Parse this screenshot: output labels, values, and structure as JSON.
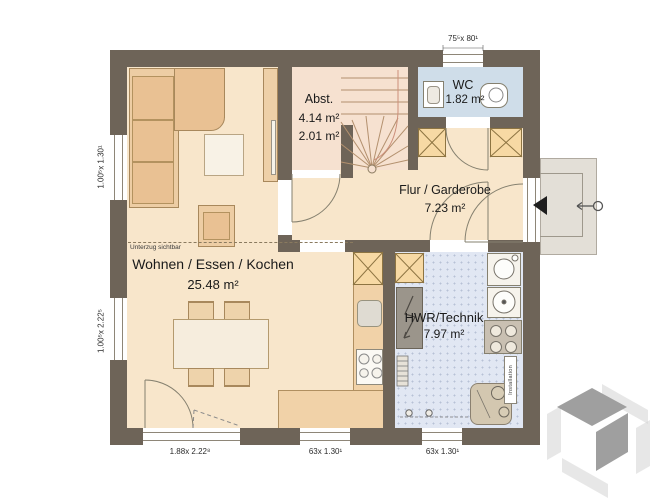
{
  "plan": {
    "rooms": {
      "wohnen": {
        "name": "Wohnen / Essen / Kochen",
        "area": "25.48 m²"
      },
      "abst": {
        "name": "Abst.",
        "area1": "4.14 m²",
        "area2": "2.01 m²"
      },
      "wc": {
        "name": "WC",
        "area": "1.82 m²"
      },
      "flur": {
        "name": "Flur / Garderobe",
        "area": "7.23 m²"
      },
      "hwr": {
        "name": "HWR/Technik",
        "area": "7.97 m²"
      }
    },
    "annotations": {
      "unterzug": "Unterzug sichtbar",
      "installation": "Installation"
    },
    "dimensions": {
      "top_window": "75⁵x 80¹",
      "left_upper_window": "1.00⁵x 1.30¹",
      "left_lower_window": "1.00⁵x 2.22⁵",
      "bottom_terrace_door": "1.88x 2.22⁸",
      "bottom_mid_window": "63x 1.30¹",
      "bottom_right_window": "63x 1.30¹"
    },
    "colors": {
      "wall": "#6e6458",
      "floor_main": "#f8e6cb",
      "floor_abst": "#f6e1d0",
      "floor_wc": "#cfdde9",
      "floor_hwr": "#e1e7f3",
      "kitchen_counter": "#f1d2a8",
      "shaft": "#f7d9a4",
      "porch": "#e3dfd7",
      "sofa": "#edcda4"
    }
  }
}
